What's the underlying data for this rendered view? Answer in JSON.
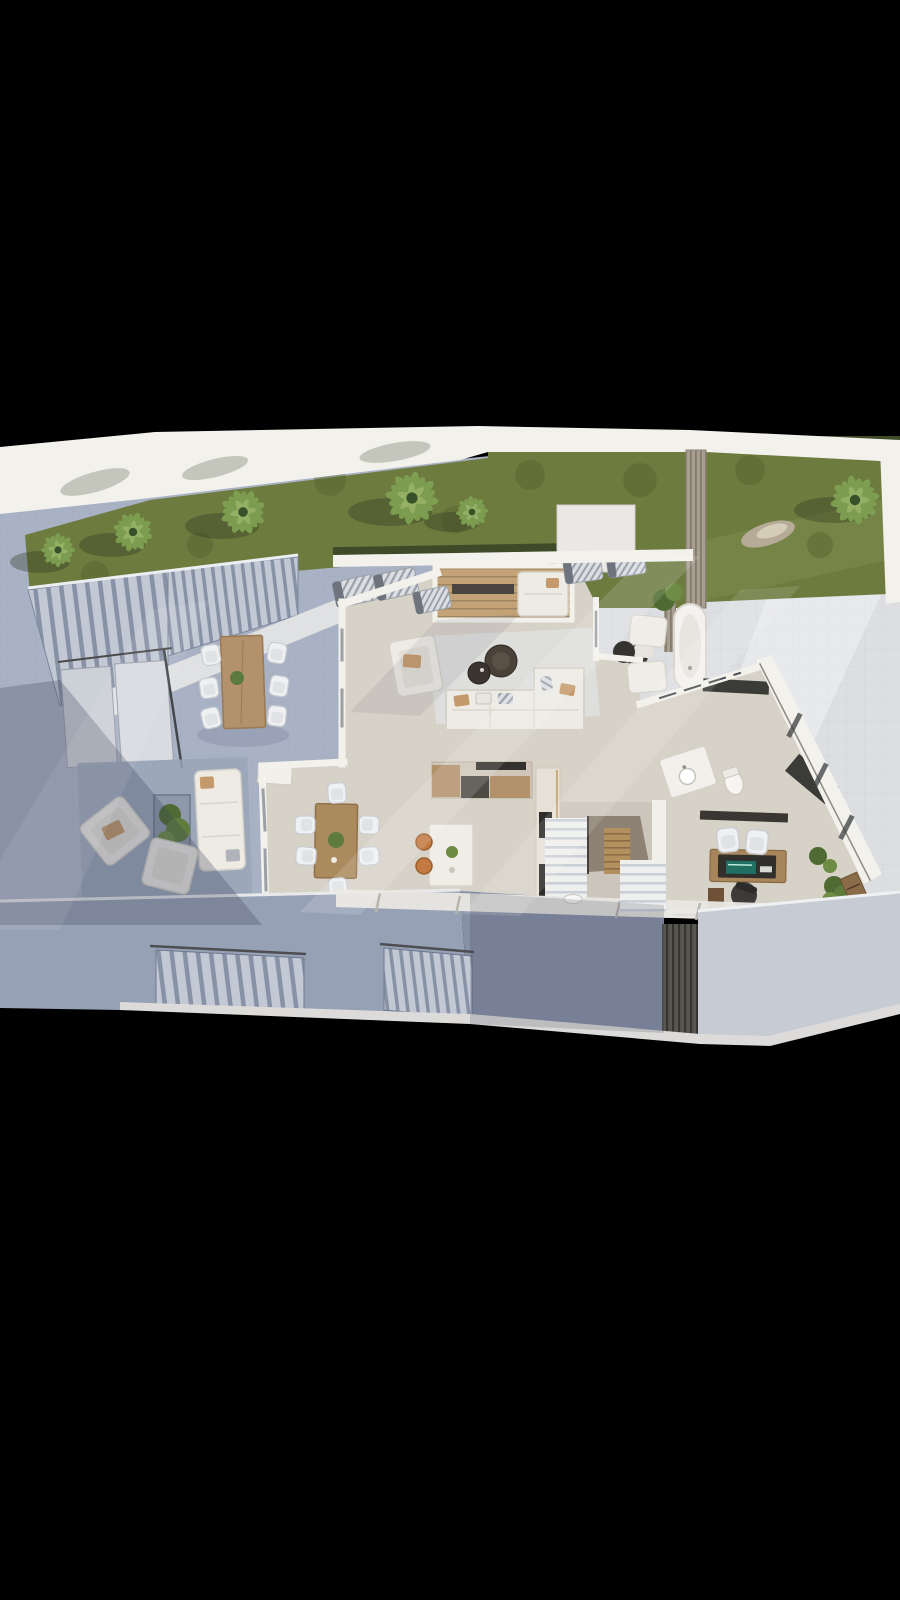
{
  "scene": {
    "type": "3d-floor-plan-render",
    "view": "top-down architectural visualization of a villa ground floor, centered on a black backdrop",
    "background": "#000000",
    "areas": [
      "garden-lawn",
      "palm-trees",
      "roof-parapet-band",
      "privacy-slat-wall",
      "lawn-rock",
      "left-paved-terrace",
      "exterior-staircase",
      "terrace-walkway",
      "glass-panels",
      "outdoor-dining-set",
      "outdoor-lounge-set",
      "covered-deck-nook",
      "sun-loungers",
      "living-room",
      "sofa-l-shape",
      "coffee-tables",
      "armchair",
      "kitchen",
      "kitchen-island",
      "bar-stools",
      "tall-appliance-unit",
      "interior-dining-set",
      "sideboard",
      "interior-staircase",
      "home-office-desk",
      "office-chairs",
      "bookshelf",
      "potted-plants",
      "bathroom-vanity",
      "toilet",
      "outdoor-bathtub-terrace",
      "dark-benches",
      "lower-facade-walls",
      "street-stairs",
      "slatted-pillar",
      "front-walkway"
    ],
    "counts": {
      "palm_trees": 6,
      "outdoor_dining_chairs": 6,
      "interior_dining_chairs": 6,
      "sun_loungers": 5,
      "coffee_tables": 3,
      "bar_stools": 2,
      "office_guest_chairs": 2
    }
  },
  "palette": {
    "black": "#000000",
    "wallWhite": "#f3f1eb",
    "wallShade": "#dcd9d2",
    "grass": "#6d7b3f",
    "grassDark": "#55632f",
    "grassLight": "#879455",
    "hedge": "#3e4a28",
    "palm": "#7fa052",
    "palmDark": "#46602e",
    "terrace": "#a9b2c4",
    "terraceShade": "#8d97ad",
    "wallFace": "#97a1b5",
    "wallFaceDark": "#8791a6",
    "wallFaceLight": "#c6cbd4",
    "paving": "#dcdee2",
    "pavingLight": "#efefed",
    "floor": "#d7d2c8",
    "floorShade": "#c6c0b6",
    "rug": "#dfe0de",
    "wood": "#b3916a",
    "woodDark": "#9a7a52",
    "deckWood": "#c2a276",
    "sofa": "#edebe4",
    "sofaStroke": "#d5d2c9",
    "cushionTan": "#c49a6c",
    "dark": "#3b3833",
    "stair": "#c3c9d4",
    "stairGap": "#8892a6",
    "stepWhite": "#efefed",
    "stepGap": "#cbd0d8",
    "orange": "#c27a41",
    "screenTeal": "#1f6f63",
    "walkway": "#dcdbd9",
    "planter": "#8e98aa"
  }
}
